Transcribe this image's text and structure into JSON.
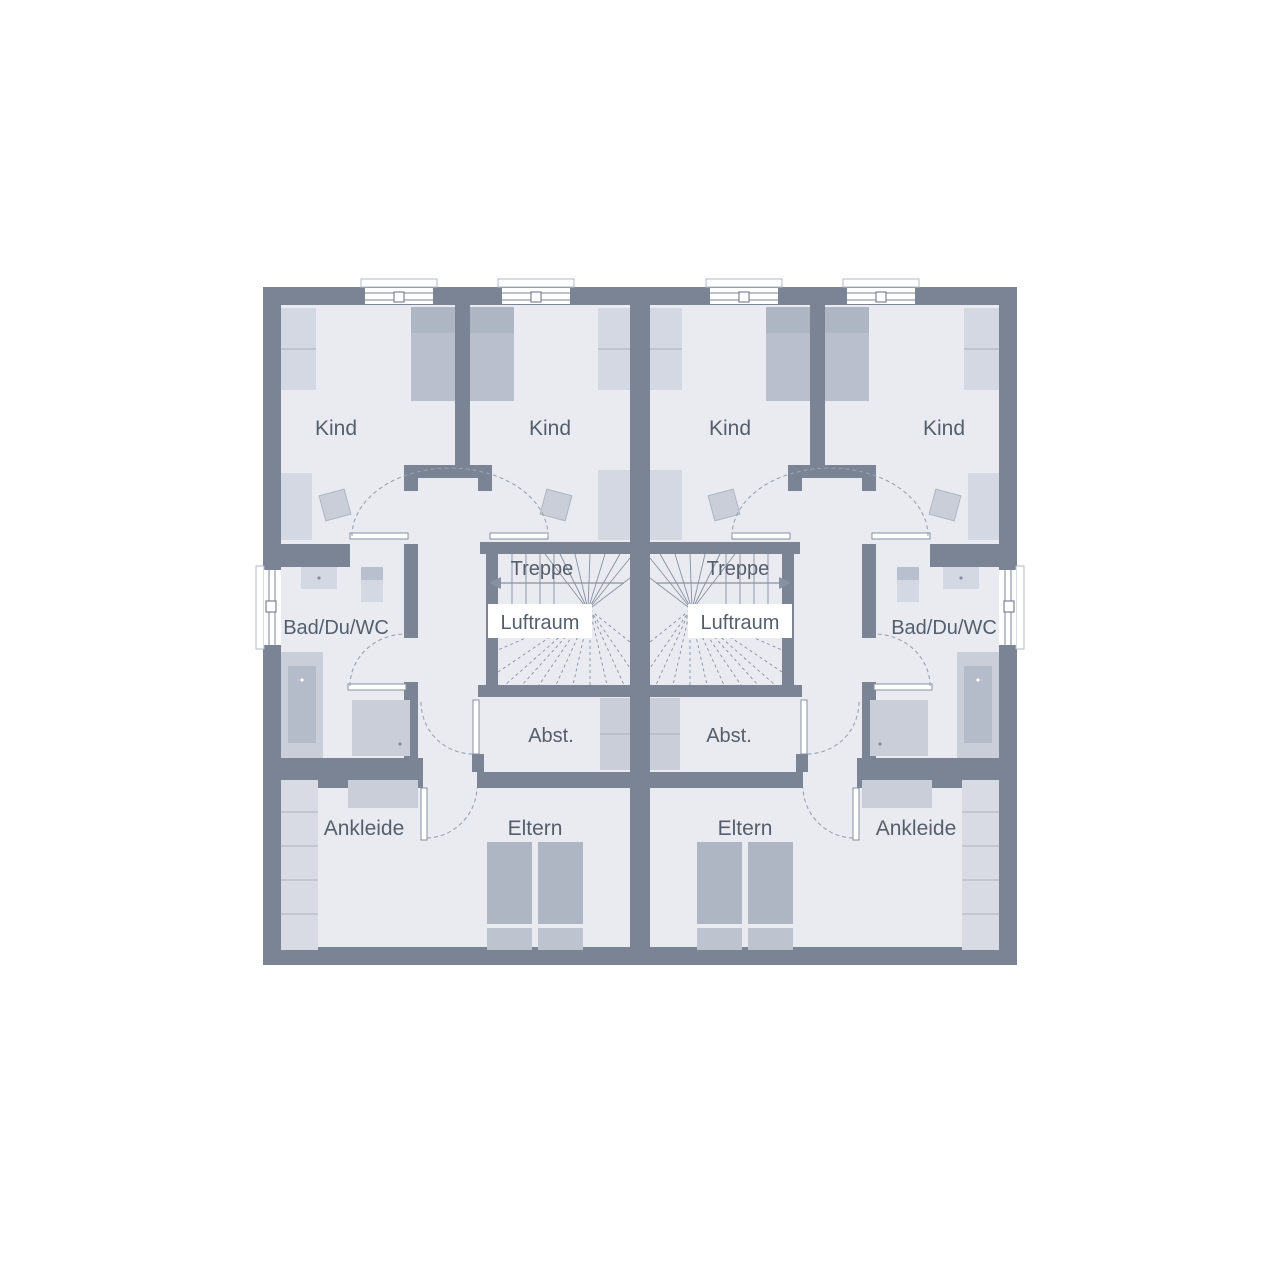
{
  "plan": {
    "name": "Obergeschoss Grundriss Doppelhaus",
    "rooms": {
      "kind": "Kind",
      "treppe": "Treppe",
      "luftraum": "Luftraum",
      "bad": "Bad/Du/WC",
      "abst": "Abst.",
      "ankleide": "Ankleide",
      "eltern": "Eltern"
    },
    "colors": {
      "background": "#ffffff",
      "wall": "#7b8494",
      "floor": "#e9ebf1",
      "furniture_light": "#d4d8e2",
      "furniture_lighter": "#d8dbe4",
      "furniture_medium": "#c9ced9",
      "furniture_dark": "#aeb5c3",
      "bed_body": "#b9bfcc",
      "bed_foot": "#bdc3cf",
      "tub_inner": "#b4bbc9",
      "stair_line": "#8791a1",
      "dash_line": "#9aa2b0",
      "divider_line": "#b3b9c5",
      "window_frame": "#7b8494",
      "text": "#565e6c",
      "white": "#ffffff"
    }
  }
}
